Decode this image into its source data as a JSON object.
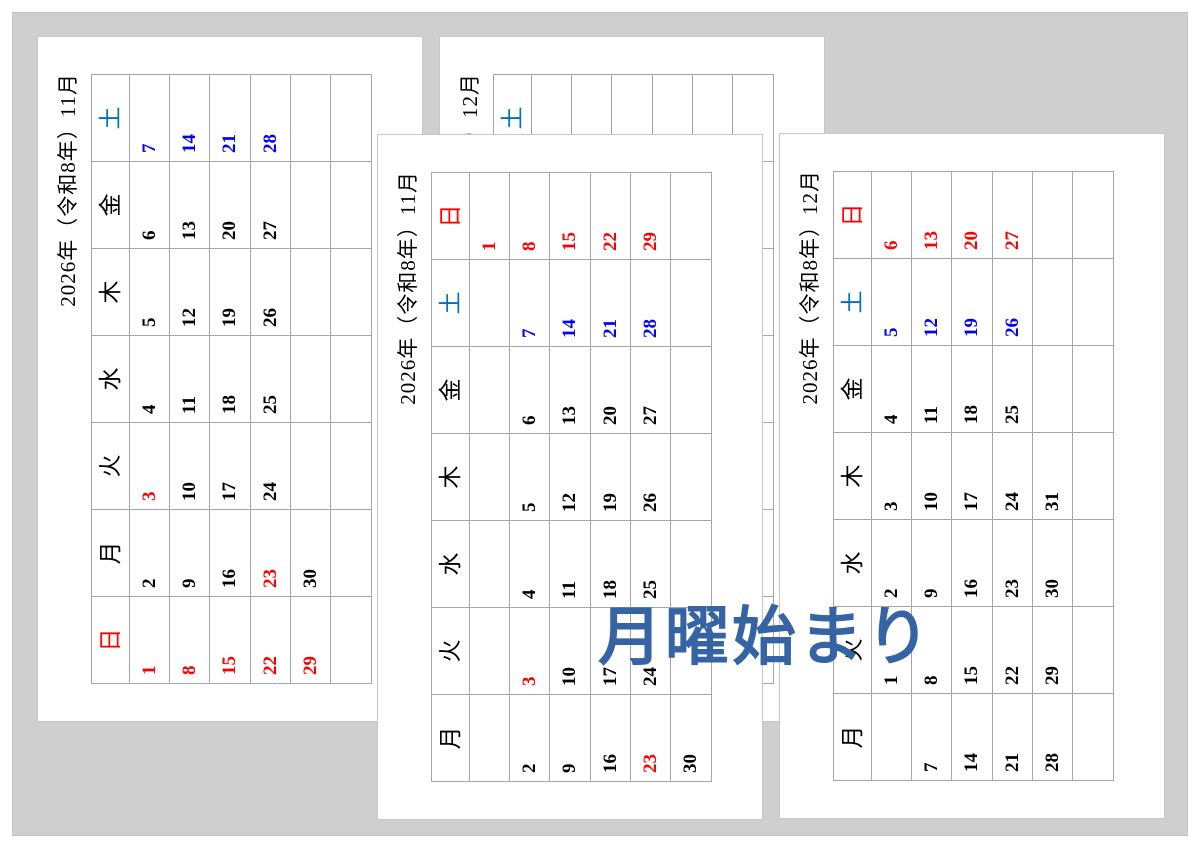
{
  "colors": {
    "background_gray": "#cfcfcf",
    "page_white": "#ffffff",
    "grid_gray": "#a6a6a6",
    "text_black": "#000000",
    "sunday_red": "#ff0000",
    "saturday_blue": "#0000ff",
    "saturday_header_blue": "#0070c0",
    "overlay_blue": "#3563a3"
  },
  "overlay_label": {
    "text": "月曜始まり",
    "color": "#3563a3"
  },
  "pages": [
    {
      "id": "november-sunday-start",
      "title": "2026年（令和8年）11月",
      "week_start": "sunday",
      "weekday_headers": [
        {
          "label": "日",
          "color": "#ff0000"
        },
        {
          "label": "月",
          "color": "#000000"
        },
        {
          "label": "火",
          "color": "#000000"
        },
        {
          "label": "水",
          "color": "#000000"
        },
        {
          "label": "木",
          "color": "#000000"
        },
        {
          "label": "金",
          "color": "#000000"
        },
        {
          "label": "土",
          "color": "#0070c0"
        }
      ],
      "weeks": [
        [
          {
            "day": "1",
            "color": "#ff0000"
          },
          {
            "day": "2",
            "color": "#000000"
          },
          {
            "day": "3",
            "color": "#ff0000"
          },
          {
            "day": "4",
            "color": "#000000"
          },
          {
            "day": "5",
            "color": "#000000"
          },
          {
            "day": "6",
            "color": "#000000"
          },
          {
            "day": "7",
            "color": "#0000ff"
          }
        ],
        [
          {
            "day": "8",
            "color": "#ff0000"
          },
          {
            "day": "9",
            "color": "#000000"
          },
          {
            "day": "10",
            "color": "#000000"
          },
          {
            "day": "11",
            "color": "#000000"
          },
          {
            "day": "12",
            "color": "#000000"
          },
          {
            "day": "13",
            "color": "#000000"
          },
          {
            "day": "14",
            "color": "#0000ff"
          }
        ],
        [
          {
            "day": "15",
            "color": "#ff0000"
          },
          {
            "day": "16",
            "color": "#000000"
          },
          {
            "day": "17",
            "color": "#000000"
          },
          {
            "day": "18",
            "color": "#000000"
          },
          {
            "day": "19",
            "color": "#000000"
          },
          {
            "day": "20",
            "color": "#000000"
          },
          {
            "day": "21",
            "color": "#0000ff"
          }
        ],
        [
          {
            "day": "22",
            "color": "#ff0000"
          },
          {
            "day": "23",
            "color": "#ff0000"
          },
          {
            "day": "24",
            "color": "#000000"
          },
          {
            "day": "25",
            "color": "#000000"
          },
          {
            "day": "26",
            "color": "#000000"
          },
          {
            "day": "27",
            "color": "#000000"
          },
          {
            "day": "28",
            "color": "#0000ff"
          }
        ],
        [
          {
            "day": "29",
            "color": "#ff0000"
          },
          {
            "day": "30",
            "color": "#000000"
          },
          null,
          null,
          null,
          null,
          null
        ],
        [
          null,
          null,
          null,
          null,
          null,
          null,
          null
        ]
      ]
    },
    {
      "id": "december-sunday-start",
      "title": "2026年（令和8年）12月",
      "week_start": "sunday",
      "weekday_headers": [
        {
          "label": "日",
          "color": "#ff0000"
        },
        {
          "label": "月",
          "color": "#000000"
        },
        {
          "label": "火",
          "color": "#000000"
        },
        {
          "label": "水",
          "color": "#000000"
        },
        {
          "label": "木",
          "color": "#000000"
        },
        {
          "label": "金",
          "color": "#000000"
        },
        {
          "label": "土",
          "color": "#0070c0"
        }
      ],
      "weeks": [
        [
          null,
          null,
          {
            "day": "1",
            "color": "#000000"
          },
          {
            "day": "2",
            "color": "#000000"
          },
          {
            "day": "3",
            "color": "#000000"
          },
          {
            "day": "4",
            "color": "#000000"
          },
          {
            "day": "5",
            "color": "#0000ff"
          }
        ],
        [
          {
            "day": "6",
            "color": "#ff0000"
          },
          {
            "day": "7",
            "color": "#000000"
          },
          {
            "day": "8",
            "color": "#000000"
          },
          {
            "day": "9",
            "color": "#000000"
          },
          {
            "day": "10",
            "color": "#000000"
          },
          {
            "day": "11",
            "color": "#000000"
          },
          {
            "day": "12",
            "color": "#0000ff"
          }
        ],
        [
          {
            "day": "13",
            "color": "#ff0000"
          },
          {
            "day": "14",
            "color": "#000000"
          },
          {
            "day": "15",
            "color": "#000000"
          },
          {
            "day": "16",
            "color": "#000000"
          },
          {
            "day": "17",
            "color": "#000000"
          },
          {
            "day": "18",
            "color": "#000000"
          },
          {
            "day": "19",
            "color": "#0000ff"
          }
        ],
        [
          {
            "day": "20",
            "color": "#ff0000"
          },
          {
            "day": "21",
            "color": "#000000"
          },
          {
            "day": "22",
            "color": "#000000"
          },
          {
            "day": "23",
            "color": "#000000"
          },
          {
            "day": "24",
            "color": "#000000"
          },
          {
            "day": "25",
            "color": "#000000"
          },
          {
            "day": "26",
            "color": "#0000ff"
          }
        ],
        [
          {
            "day": "27",
            "color": "#ff0000"
          },
          {
            "day": "28",
            "color": "#000000"
          },
          {
            "day": "29",
            "color": "#000000"
          },
          {
            "day": "30",
            "color": "#000000"
          },
          {
            "day": "31",
            "color": "#000000"
          },
          null,
          null
        ],
        [
          null,
          null,
          null,
          null,
          null,
          null,
          null
        ]
      ]
    },
    {
      "id": "november-monday-start",
      "title": "2026年（令和8年）11月",
      "week_start": "monday",
      "weekday_headers": [
        {
          "label": "月",
          "color": "#000000"
        },
        {
          "label": "火",
          "color": "#000000"
        },
        {
          "label": "水",
          "color": "#000000"
        },
        {
          "label": "木",
          "color": "#000000"
        },
        {
          "label": "金",
          "color": "#000000"
        },
        {
          "label": "土",
          "color": "#0070c0"
        },
        {
          "label": "日",
          "color": "#ff0000"
        }
      ],
      "weeks": [
        [
          null,
          null,
          null,
          null,
          null,
          null,
          {
            "day": "1",
            "color": "#ff0000"
          }
        ],
        [
          {
            "day": "2",
            "color": "#000000"
          },
          {
            "day": "3",
            "color": "#ff0000"
          },
          {
            "day": "4",
            "color": "#000000"
          },
          {
            "day": "5",
            "color": "#000000"
          },
          {
            "day": "6",
            "color": "#000000"
          },
          {
            "day": "7",
            "color": "#0000ff"
          },
          {
            "day": "8",
            "color": "#ff0000"
          }
        ],
        [
          {
            "day": "9",
            "color": "#000000"
          },
          {
            "day": "10",
            "color": "#000000"
          },
          {
            "day": "11",
            "color": "#000000"
          },
          {
            "day": "12",
            "color": "#000000"
          },
          {
            "day": "13",
            "color": "#000000"
          },
          {
            "day": "14",
            "color": "#0000ff"
          },
          {
            "day": "15",
            "color": "#ff0000"
          }
        ],
        [
          {
            "day": "16",
            "color": "#000000"
          },
          {
            "day": "17",
            "color": "#000000"
          },
          {
            "day": "18",
            "color": "#000000"
          },
          {
            "day": "19",
            "color": "#000000"
          },
          {
            "day": "20",
            "color": "#000000"
          },
          {
            "day": "21",
            "color": "#0000ff"
          },
          {
            "day": "22",
            "color": "#ff0000"
          }
        ],
        [
          {
            "day": "23",
            "color": "#ff0000"
          },
          {
            "day": "24",
            "color": "#000000"
          },
          {
            "day": "25",
            "color": "#000000"
          },
          {
            "day": "26",
            "color": "#000000"
          },
          {
            "day": "27",
            "color": "#000000"
          },
          {
            "day": "28",
            "color": "#0000ff"
          },
          {
            "day": "29",
            "color": "#ff0000"
          }
        ],
        [
          {
            "day": "30",
            "color": "#000000"
          },
          null,
          null,
          null,
          null,
          null,
          null
        ]
      ]
    },
    {
      "id": "december-monday-start",
      "title": "2026年（令和8年）12月",
      "week_start": "monday",
      "weekday_headers": [
        {
          "label": "月",
          "color": "#000000"
        },
        {
          "label": "火",
          "color": "#000000"
        },
        {
          "label": "水",
          "color": "#000000"
        },
        {
          "label": "木",
          "color": "#000000"
        },
        {
          "label": "金",
          "color": "#000000"
        },
        {
          "label": "土",
          "color": "#0070c0"
        },
        {
          "label": "日",
          "color": "#ff0000"
        }
      ],
      "weeks": [
        [
          null,
          {
            "day": "1",
            "color": "#000000"
          },
          {
            "day": "2",
            "color": "#000000"
          },
          {
            "day": "3",
            "color": "#000000"
          },
          {
            "day": "4",
            "color": "#000000"
          },
          {
            "day": "5",
            "color": "#0000ff"
          },
          {
            "day": "6",
            "color": "#ff0000"
          }
        ],
        [
          {
            "day": "7",
            "color": "#000000"
          },
          {
            "day": "8",
            "color": "#000000"
          },
          {
            "day": "9",
            "color": "#000000"
          },
          {
            "day": "10",
            "color": "#000000"
          },
          {
            "day": "11",
            "color": "#000000"
          },
          {
            "day": "12",
            "color": "#0000ff"
          },
          {
            "day": "13",
            "color": "#ff0000"
          }
        ],
        [
          {
            "day": "14",
            "color": "#000000"
          },
          {
            "day": "15",
            "color": "#000000"
          },
          {
            "day": "16",
            "color": "#000000"
          },
          {
            "day": "17",
            "color": "#000000"
          },
          {
            "day": "18",
            "color": "#000000"
          },
          {
            "day": "19",
            "color": "#0000ff"
          },
          {
            "day": "20",
            "color": "#ff0000"
          }
        ],
        [
          {
            "day": "21",
            "color": "#000000"
          },
          {
            "day": "22",
            "color": "#000000"
          },
          {
            "day": "23",
            "color": "#000000"
          },
          {
            "day": "24",
            "color": "#000000"
          },
          {
            "day": "25",
            "color": "#000000"
          },
          {
            "day": "26",
            "color": "#0000ff"
          },
          {
            "day": "27",
            "color": "#ff0000"
          }
        ],
        [
          {
            "day": "28",
            "color": "#000000"
          },
          {
            "day": "29",
            "color": "#000000"
          },
          {
            "day": "30",
            "color": "#000000"
          },
          {
            "day": "31",
            "color": "#000000"
          },
          null,
          null,
          null
        ],
        [
          null,
          null,
          null,
          null,
          null,
          null,
          null
        ]
      ]
    }
  ]
}
